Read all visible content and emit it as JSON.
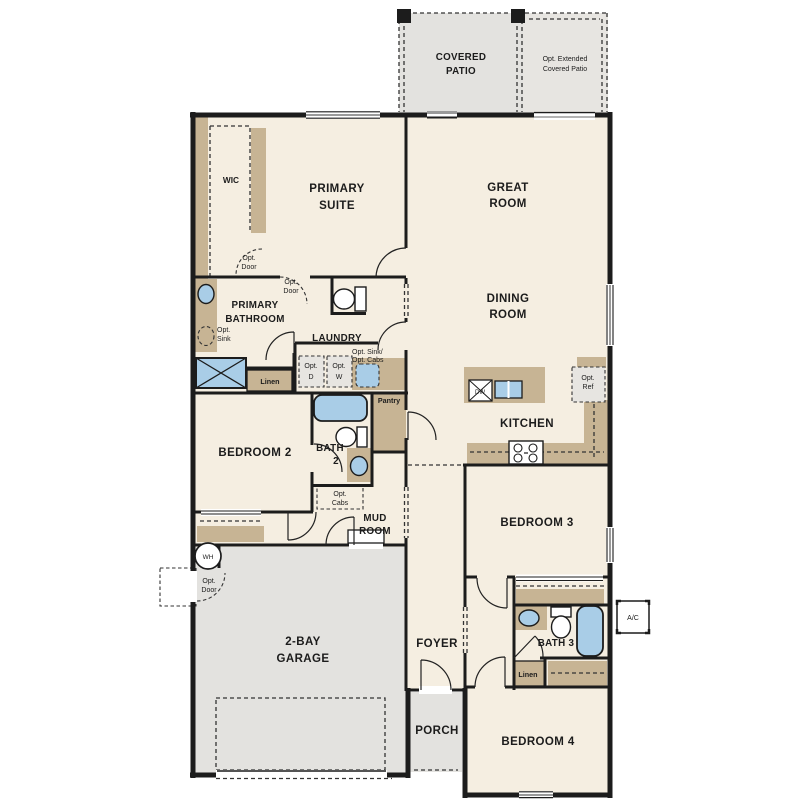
{
  "title": "Single-story floor plan",
  "palette": {
    "wall": "#1c1c1c",
    "floor": "#f5eee1",
    "cabinet_tan": "#c7b494",
    "fixture_blue": "#a9cde7",
    "garage_gray": "#e3e2df",
    "optional_gray": "#e7e5e1",
    "patio_gray": "#e4e3e0",
    "window_gray": "#9a9a9a"
  },
  "rooms": {
    "covered_patio": [
      "COVERED",
      "PATIO"
    ],
    "opt_extended_patio": [
      "Opt. Extended",
      "Covered Patio"
    ],
    "wic": [
      "WIC"
    ],
    "primary_suite": [
      "PRIMARY",
      "SUITE"
    ],
    "great_room": [
      "GREAT",
      "ROOM"
    ],
    "dining_room": [
      "DINING",
      "ROOM"
    ],
    "primary_bathroom": [
      "PRIMARY",
      "BATHROOM"
    ],
    "laundry": [
      "LAUNDRY"
    ],
    "kitchen": [
      "KITCHEN"
    ],
    "bedroom2": [
      "BEDROOM 2"
    ],
    "bath2": [
      "BATH",
      "2"
    ],
    "mud_room": [
      "MUD",
      "ROOM"
    ],
    "bedroom3": [
      "BEDROOM 3"
    ],
    "bath3": [
      "BATH 3"
    ],
    "garage": [
      "2-BAY",
      "GARAGE"
    ],
    "foyer": [
      "FOYER"
    ],
    "porch": [
      "PORCH"
    ],
    "bedroom4": [
      "BEDROOM 4"
    ]
  },
  "features": {
    "opt_door": [
      "Opt.",
      "Door"
    ],
    "opt_sink": [
      "Opt.",
      "Sink"
    ],
    "opt_sink_cabs": [
      "Opt. Sink/",
      "Opt. Cabs"
    ],
    "opt_dryer": [
      "Opt.",
      "D"
    ],
    "opt_washer": [
      "Opt.",
      "W"
    ],
    "opt_cabs": [
      "Opt.",
      "Cabs"
    ],
    "opt_ref": [
      "Opt.",
      "Ref"
    ],
    "linen": [
      "Linen"
    ],
    "pantry": [
      "Pantry"
    ],
    "dishwasher": [
      "DW"
    ],
    "water_heater": [
      "WH"
    ],
    "ac_unit": [
      "A/C"
    ]
  }
}
